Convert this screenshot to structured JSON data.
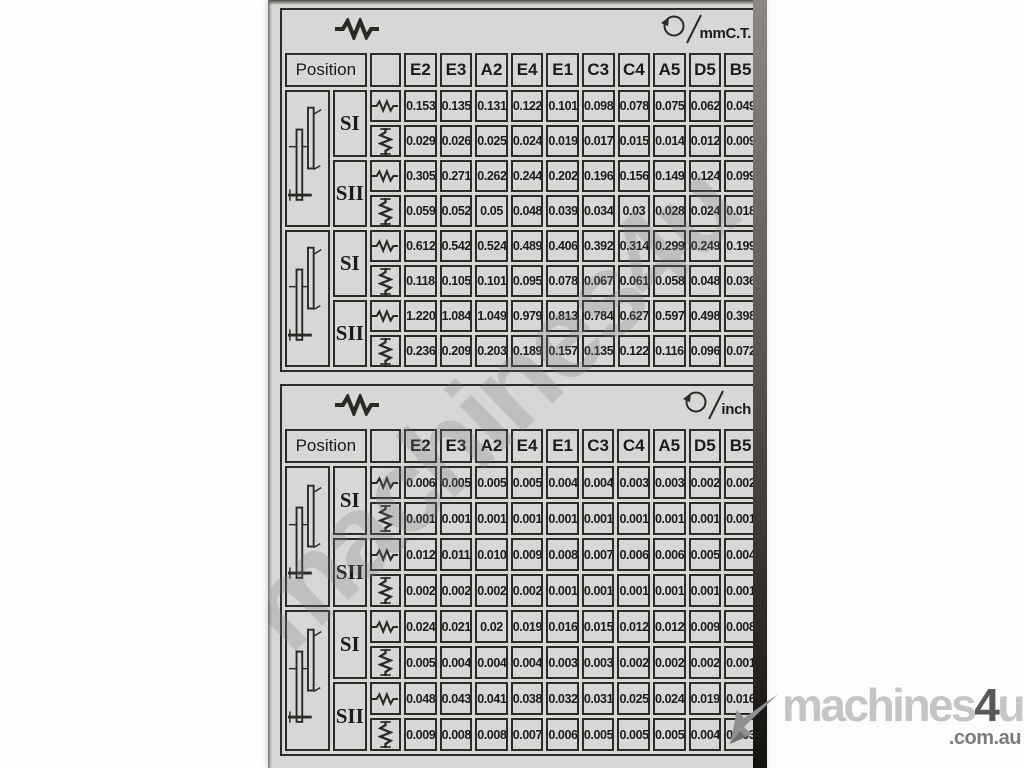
{
  "page": {
    "background": "#ffffff"
  },
  "plate": {
    "background": "#d8d7d5",
    "line_color": "#2d2b28"
  },
  "columns": [
    "E2",
    "E3",
    "A2",
    "E4",
    "E1",
    "C3",
    "C4",
    "A5",
    "D5",
    "B5"
  ],
  "icons": {
    "longitudinal_feed": "zigzag-horizontal",
    "cross_feed": "zigzag-vertical",
    "per_revolution": "circle-arrow",
    "gear_position": "shift-lever-diagram"
  },
  "tables": [
    {
      "unit_label": "mmC.T.",
      "position_label": "Position",
      "groups": [
        {
          "rows": [
            {
              "label": "SI",
              "longitudinal": [
                "0.153",
                "0.135",
                "0.131",
                "0.122",
                "0.101",
                "0.098",
                "0.078",
                "0.075",
                "0.062",
                "0.049"
              ],
              "cross": [
                "0.0296",
                "0.026",
                "0.025",
                "0.024",
                "0.019",
                "0.017",
                "0.015",
                "0.014",
                "0.012",
                "0.009"
              ]
            },
            {
              "label": "SII",
              "longitudinal": [
                "0.305",
                "0.271",
                "0.262",
                "0.244",
                "0.202",
                "0.196",
                "0.156",
                "0.149",
                "0.124",
                "0.099"
              ],
              "cross": [
                "0.059",
                "0.052",
                "0.05",
                "0.048",
                "0.039",
                "0.034",
                "0.03",
                "0.028",
                "0.024",
                "0.018"
              ]
            }
          ]
        },
        {
          "rows": [
            {
              "label": "SI",
              "longitudinal": [
                "0.612",
                "0.542",
                "0.524",
                "0.489",
                "0.406",
                "0.392",
                "0.314",
                "0.299",
                "0.249",
                "0.199"
              ],
              "cross": [
                "0.118",
                "0.105",
                "0.101",
                "0.095",
                "0.078",
                "0.067",
                "0.061",
                "0.058",
                "0.048",
                "0.036"
              ]
            },
            {
              "label": "SII",
              "longitudinal": [
                "1.220",
                "1.084",
                "1.049",
                "0.979",
                "0.813",
                "0.784",
                "0.627",
                "0.597",
                "0.498",
                "0.398"
              ],
              "cross": [
                "0.236",
                "0.209",
                "0.203",
                "0.189",
                "0.157",
                "0.135",
                "0.122",
                "0.116",
                "0.096",
                "0.072"
              ]
            }
          ]
        }
      ]
    },
    {
      "unit_label": "inch",
      "position_label": "Position",
      "groups": [
        {
          "rows": [
            {
              "label": "SI",
              "longitudinal": [
                "0.006",
                "0.005",
                "0.005",
                "0.005",
                "0.004",
                "0.004",
                "0.003",
                "0.003",
                "0.002",
                "0.002"
              ],
              "cross": [
                "0.001",
                "0.001",
                "0.001",
                "0.001",
                "0.001",
                "0.001",
                "0.001",
                "0.001",
                "0.001",
                "0.001"
              ]
            },
            {
              "label": "SII",
              "longitudinal": [
                "0.012",
                "0.011",
                "0.010",
                "0.009",
                "0.008",
                "0.007",
                "0.006",
                "0.006",
                "0.005",
                "0.004"
              ],
              "cross": [
                "0.002",
                "0.002",
                "0.002",
                "0.002",
                "0.001",
                "0.001",
                "0.001",
                "0.001",
                "0.001",
                "0.001"
              ]
            }
          ]
        },
        {
          "rows": [
            {
              "label": "SI",
              "longitudinal": [
                "0.024",
                "0.021",
                "0.02",
                "0.019",
                "0.016",
                "0.0154",
                "0.012",
                "0.012",
                "0.009",
                "0.008"
              ],
              "cross": [
                "0.005",
                "0.004",
                "0.004",
                "0.004",
                "0.003",
                "0.003",
                "0.002",
                "0.002",
                "0.002",
                "0.001"
              ]
            },
            {
              "label": "SII",
              "longitudinal": [
                "0.048",
                "0.043",
                "0.041",
                "0.038",
                "0.032",
                "0.031",
                "0.025",
                "0.024",
                "0.019",
                "0.016"
              ],
              "cross": [
                "0.009",
                "0.008",
                "0.008",
                "0.007",
                "0.006",
                "0.005",
                "0.005",
                "0.005",
                "0.004",
                "0.003"
              ]
            }
          ]
        }
      ]
    }
  ],
  "watermark": {
    "diagonal_text": "machines4u",
    "logo": {
      "part1": "machines",
      "part2": "4",
      "part3": "u",
      "domain": ".com.au",
      "light_color": "#c6c5c3",
      "dark_color": "#58585a",
      "domain_color": "#7c7c7c"
    }
  }
}
